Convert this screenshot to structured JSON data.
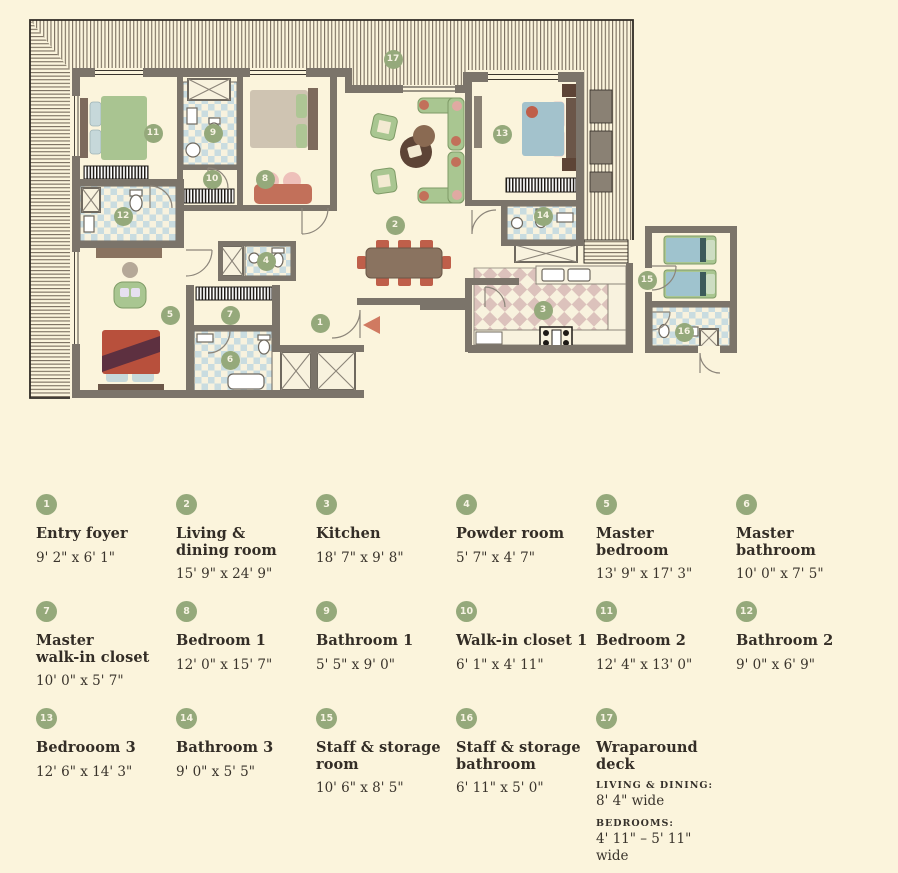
{
  "colors": {
    "background": "#FBF4DC",
    "marker_green": "#95A97B",
    "wall_gray": "#7B746A",
    "bath_checker_blue": "#C9DCE0",
    "kitchen_checker_pink": "#DCC2BC",
    "accent_red": "#C2705A",
    "furniture_green": "#A9C693",
    "bed_blue": "#A5C6D0",
    "text_dark": "#332D26"
  },
  "plan": {
    "markers": [
      "1",
      "2",
      "3",
      "4",
      "5",
      "6",
      "7",
      "8",
      "9",
      "10",
      "11",
      "12",
      "13",
      "14",
      "15",
      "16",
      "17"
    ]
  },
  "legend": {
    "items": [
      {
        "number": "1",
        "name": "Entry foyer",
        "dims": "9' 2\" x 6' 1\""
      },
      {
        "number": "2",
        "name": "Living &\ndining room",
        "dims": "15' 9\" x 24' 9\""
      },
      {
        "number": "3",
        "name": "Kitchen",
        "dims": "18' 7\" x 9' 8\""
      },
      {
        "number": "4",
        "name": "Powder room",
        "dims": "5' 7\" x 4' 7\""
      },
      {
        "number": "5",
        "name": "Master\nbedroom",
        "dims": "13' 9\" x 17' 3\""
      },
      {
        "number": "6",
        "name": "Master\nbathroom",
        "dims": "10' 0\" x 7' 5\""
      },
      {
        "number": "7",
        "name": "Master\nwalk-in closet",
        "dims": "10' 0\" x 5' 7\""
      },
      {
        "number": "8",
        "name": "Bedroom 1",
        "dims": "12' 0\" x 15' 7\""
      },
      {
        "number": "9",
        "name": "Bathroom 1",
        "dims": "5' 5\" x 9' 0\""
      },
      {
        "number": "10",
        "name": "Walk-in closet 1",
        "dims": "6' 1\" x 4' 11\""
      },
      {
        "number": "11",
        "name": "Bedroom 2",
        "dims": "12' 4\" x 13' 0\""
      },
      {
        "number": "12",
        "name": "Bathroom 2",
        "dims": "9' 0\" x 6' 9\""
      },
      {
        "number": "13",
        "name": "Bedrooom 3",
        "dims": "12' 6\" x 14' 3\""
      },
      {
        "number": "14",
        "name": "Bathroom 3",
        "dims": "9' 0\" x 5' 5\""
      },
      {
        "number": "15",
        "name": "Staff & storage\nroom",
        "dims": "10' 6\" x 8' 5\""
      },
      {
        "number": "16",
        "name": "Staff & storage\nbathroom",
        "dims": "6' 11\" x 5' 0\""
      },
      {
        "number": "17",
        "name": "Wraparound\ndeck",
        "details": [
          {
            "label": "LIVING & DINING:",
            "value": "8' 4\" wide"
          },
          {
            "label": "BEDROOMS:",
            "value": "4' 11\" – 5' 11\" wide"
          }
        ]
      }
    ]
  }
}
